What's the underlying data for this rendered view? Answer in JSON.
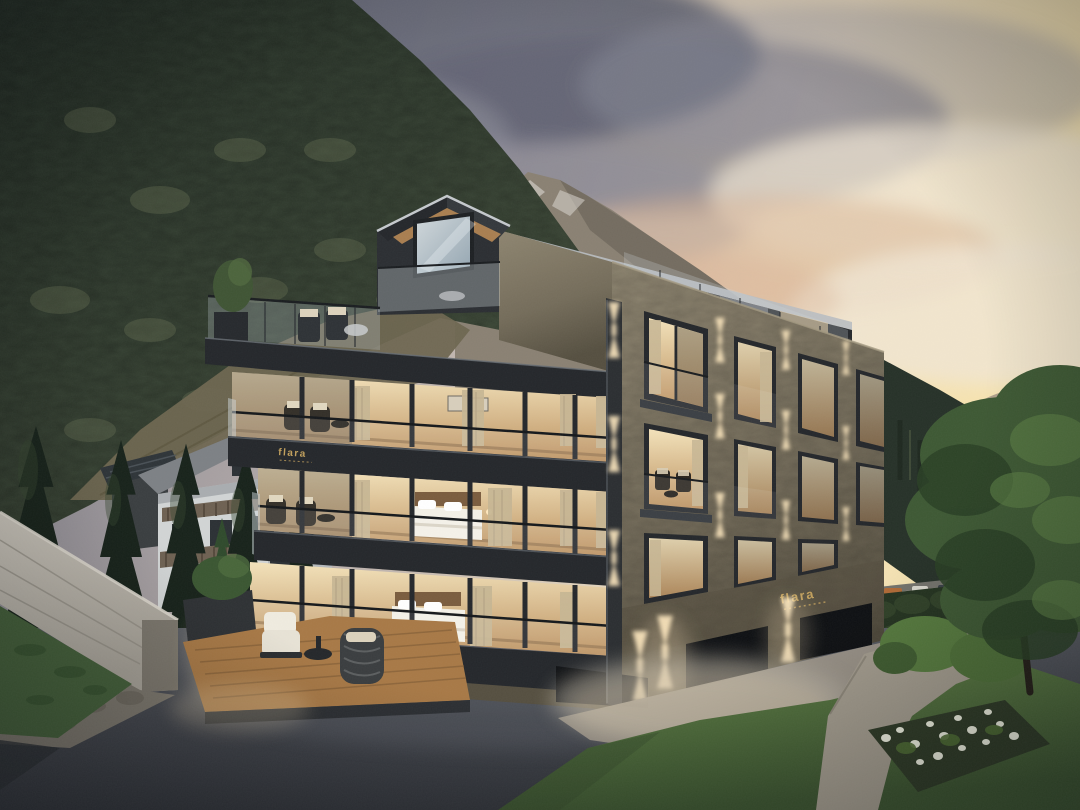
{
  "scene": {
    "type": "architectural exterior rendering",
    "time_of_day": "dusk",
    "setting": "alpine valley with forested mountainside, rocky ridge and sunset sky",
    "description": "Modern four-storey stone and glass apartment building with warm lit bedrooms, glass balconies, wall sconces and a gabled penthouse; traditional white chalet and dark conifers on the left; concrete retaining wall, asphalt driveway, lawn, garden path, white flower bed and a large tree on the right."
  },
  "logo": {
    "text": "flara",
    "color": "#c2a05c",
    "locations": [
      "upper balcony fascia",
      "entrance stone wall"
    ]
  },
  "colors": {
    "sky_left": "#7a7b89",
    "sky_mid": "#b9afac",
    "sky_warm": "#ecdcc0",
    "sky_glow": "#f7e4b0",
    "cloud_dark": "#5e6172",
    "cloud_mid": "#94939f",
    "cloud_light": "#f1e7d5",
    "cloud_peach": "#d9b394",
    "dome_hi": "#b2a28c",
    "dome_lo": "#7f7a73",
    "ridge": "#8a8173",
    "ridge_dark": "#6b6458",
    "snow": "#dad7d0",
    "forest_dark": "#263128",
    "forest_mid": "#46523e",
    "forest_hi": "#6a7355",
    "dry_hill": "#6e6650",
    "cypress": "#17221a",
    "cypress_hi": "#35462f",
    "chalet_wall": "#d2d5d5",
    "chalet_shade": "#a8adb0",
    "chalet_roof": "#7d8185",
    "chalet_wood": "#6e6152",
    "window_dark": "#2b3034",
    "pool": "#5d8292",
    "concrete_hi": "#cac5bb",
    "concrete": "#a7a298",
    "concrete_dark": "#7c776d",
    "grass_dark": "#44603a",
    "asphalt_hi": "#595c63",
    "asphalt": "#42454c",
    "asphalt_lo": "#32353b",
    "apron": "#9b9488",
    "stone_hi": "#8e8570",
    "stone": "#746c5a",
    "stone_lo": "#554f40",
    "metal": "#24272b",
    "metal_hi": "#3b3f44",
    "glass_cool": "#b6c0c7",
    "glass_warm": "#e7c894",
    "room_hi": "#f4e3bb",
    "room_lo": "#bb905e",
    "curtain": "#c7b694",
    "bed": "#f4f1e8",
    "headboard": "#7a5c3e",
    "wood": "#b08352",
    "deck": "#a87946",
    "sconce": "#ffe9c0",
    "lawn_hi": "#5f8045",
    "lawn": "#4c6a38",
    "lawn_lo": "#3c5530",
    "hedge": "#243320",
    "tree": "#3d5833",
    "tree_dark": "#293f24",
    "tree_hi": "#5c7f44",
    "flower": "#eef0e0",
    "soil": "#2e3a26",
    "road": "#73726b",
    "guard": "#b7b3a6",
    "white_house": "#eae8e0",
    "gold": "#c2a05c"
  }
}
